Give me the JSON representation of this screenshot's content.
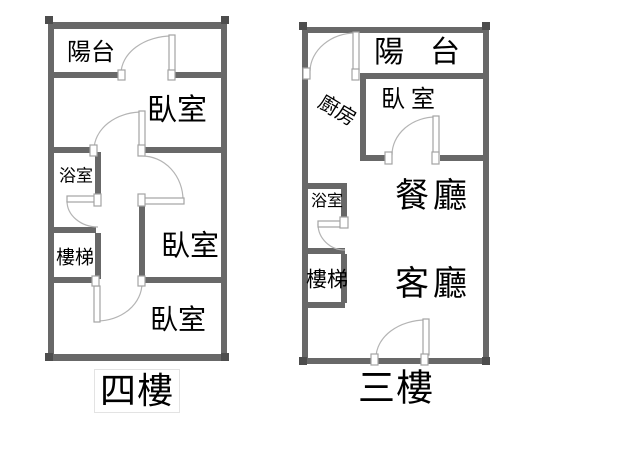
{
  "document": {
    "background": "#ffffff"
  },
  "colors": {
    "wall": "#686868",
    "wall_dark": "#4d4d4d",
    "door": "#a3a3a3",
    "arc": "#b4b4b4",
    "text": "#000000",
    "caption_box": "#e3e3e3"
  },
  "plans": [
    {
      "id": "fourth-floor",
      "caption": "四樓",
      "rooms": [
        {
          "key": "balcony",
          "label": "陽台"
        },
        {
          "key": "bedroom-upper",
          "label": "臥室"
        },
        {
          "key": "bathroom",
          "label": "浴室"
        },
        {
          "key": "stairs",
          "label": "樓梯"
        },
        {
          "key": "bedroom-middle",
          "label": "臥室"
        },
        {
          "key": "bedroom-lower",
          "label": "臥室"
        }
      ]
    },
    {
      "id": "third-floor",
      "caption": "三樓",
      "rooms": [
        {
          "key": "balcony",
          "label": "陽台"
        },
        {
          "key": "kitchen",
          "label": "廚房"
        },
        {
          "key": "bedroom",
          "label": "臥室"
        },
        {
          "key": "dining-room",
          "label": "餐廳"
        },
        {
          "key": "bathroom",
          "label": "浴室"
        },
        {
          "key": "stairs",
          "label": "樓梯"
        },
        {
          "key": "living-room",
          "label": "客廳"
        }
      ]
    }
  ]
}
